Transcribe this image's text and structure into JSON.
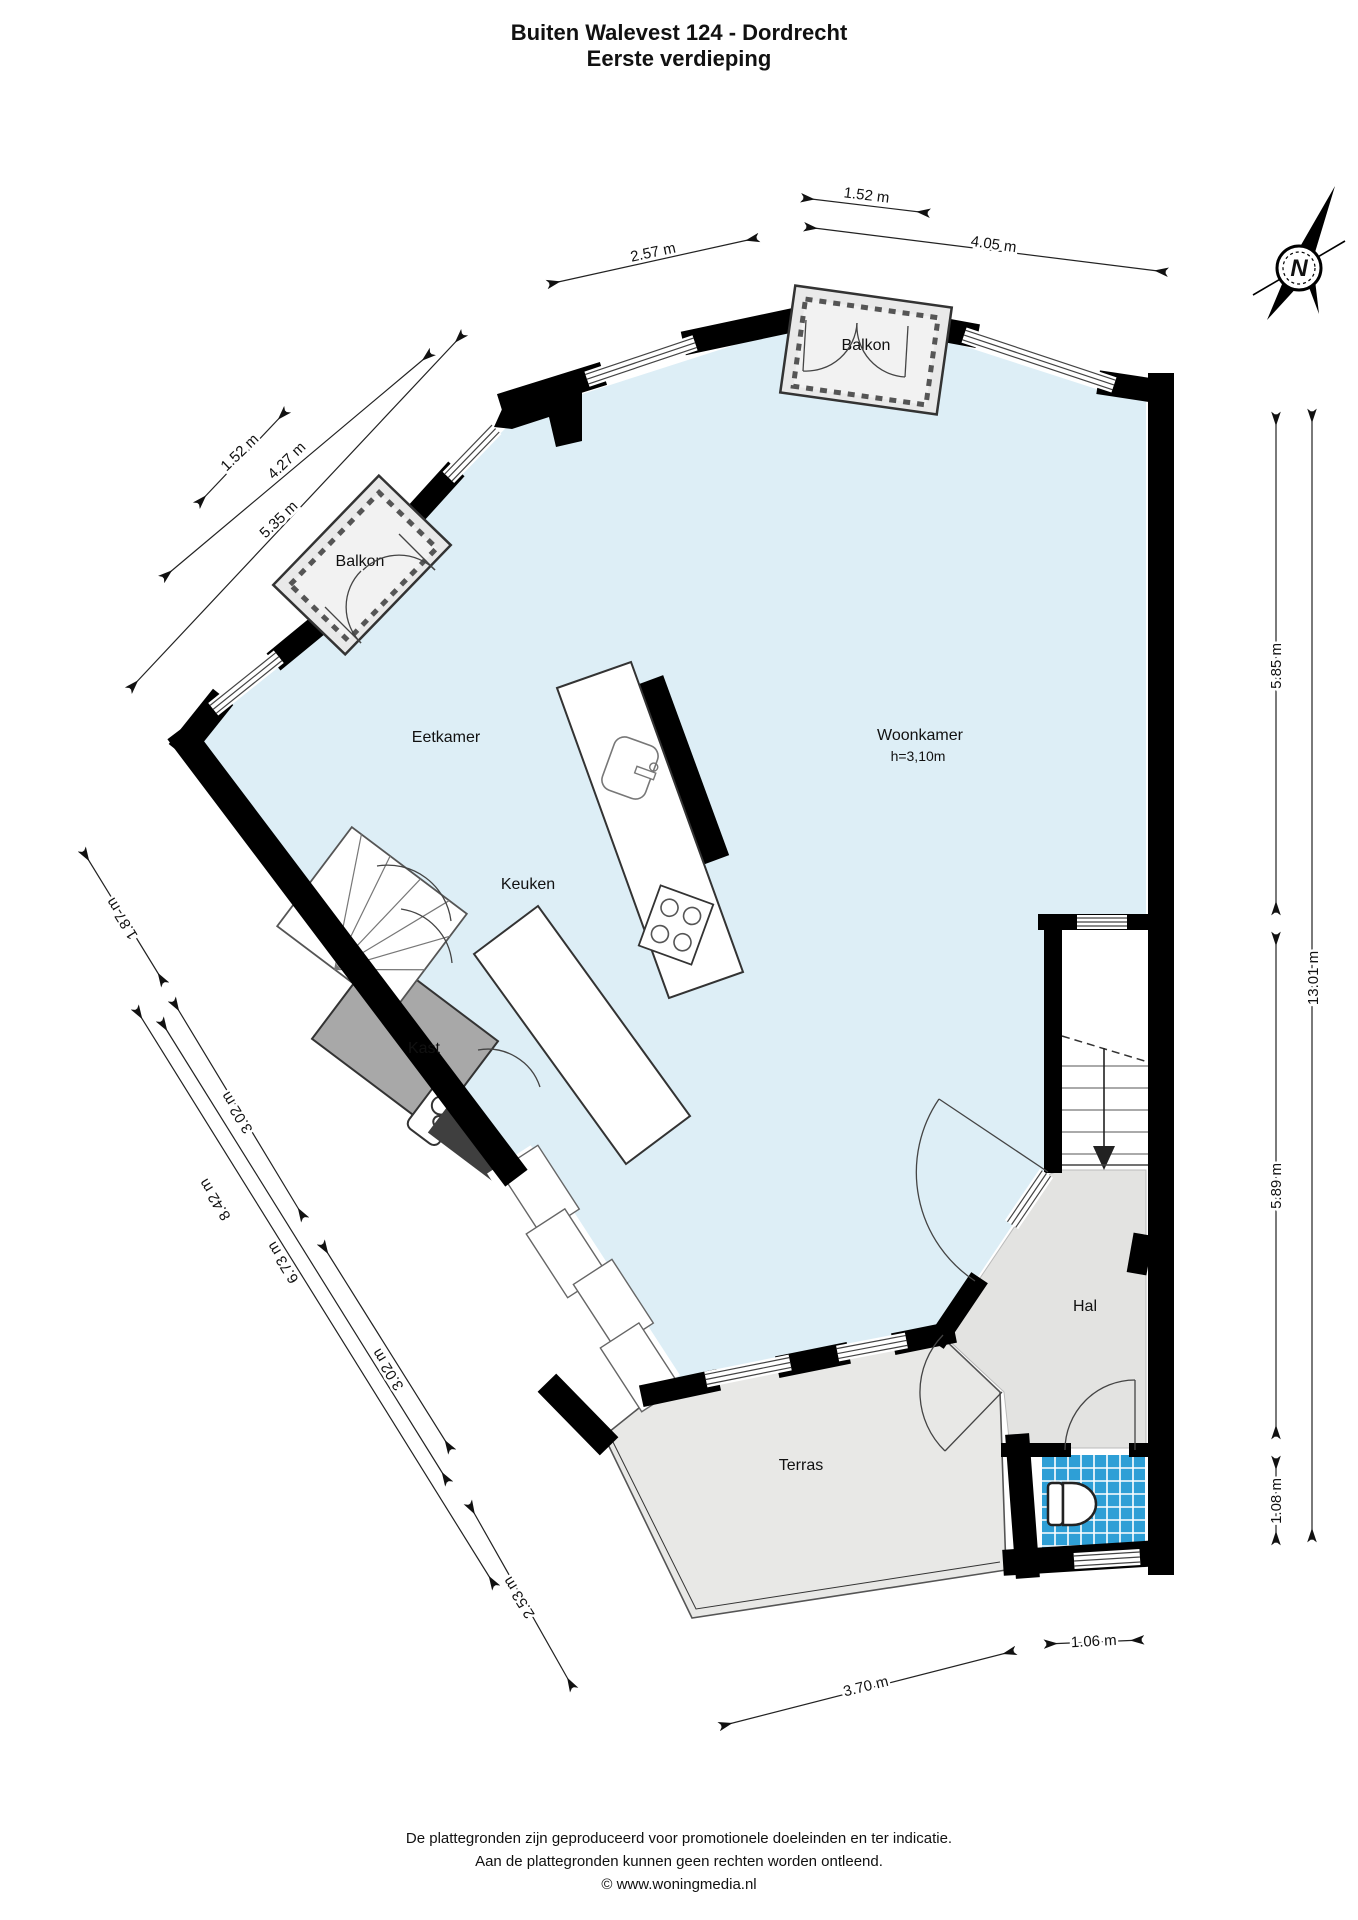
{
  "title": {
    "line1": "Buiten Walevest 124 - Dordrecht",
    "line2": "Eerste verdieping"
  },
  "compass": {
    "label": "N"
  },
  "rooms": {
    "eetkamer": {
      "label": "Eetkamer"
    },
    "keuken": {
      "label": "Keuken"
    },
    "woonkamer": {
      "label": "Woonkamer",
      "height_note": "h=3,10m"
    },
    "kast": {
      "label": "Kast"
    },
    "hal": {
      "label": "Hal"
    },
    "terras": {
      "label": "Terras"
    },
    "balkon_top": {
      "label": "Balkon"
    },
    "balkon_left": {
      "label": "Balkon"
    }
  },
  "dimensions": {
    "top_152": "1.52 m",
    "top_257": "2.57 m",
    "top_405": "4.05 m",
    "left_152": "1.52 m",
    "left_427": "4.27 m",
    "left_535": "5.35 m",
    "lower_187": "1.87 m",
    "lower_302a": "3.02 m",
    "lower_842": "8.42 m",
    "lower_673": "6.73 m",
    "lower_302b": "3.02 m",
    "lower_253": "2.53 m",
    "right_585": "5.85 m",
    "right_1301": "13.01 m",
    "right_589": "5.89 m",
    "right_108": "1.08 m",
    "bottom_106": "1.06 m",
    "bottom_370": "3.70 m"
  },
  "footer": {
    "line1": "De plattegronden zijn geproduceerd voor promotionele doeleinden en ter indicatie.",
    "line2": "Aan de plattegronden kunnen geen rechten worden ontleend.",
    "line3": "© www.woningmedia.nl"
  },
  "colors": {
    "floor_living": "#ddeef6",
    "outdoor_terrace": "#e8e8e6",
    "hallway": "#e3e3e1",
    "closet": "#a8a8a8",
    "toilet_tiles": "#2e9fd6",
    "walls": "#000000",
    "balcony": "#e9e9e9"
  }
}
